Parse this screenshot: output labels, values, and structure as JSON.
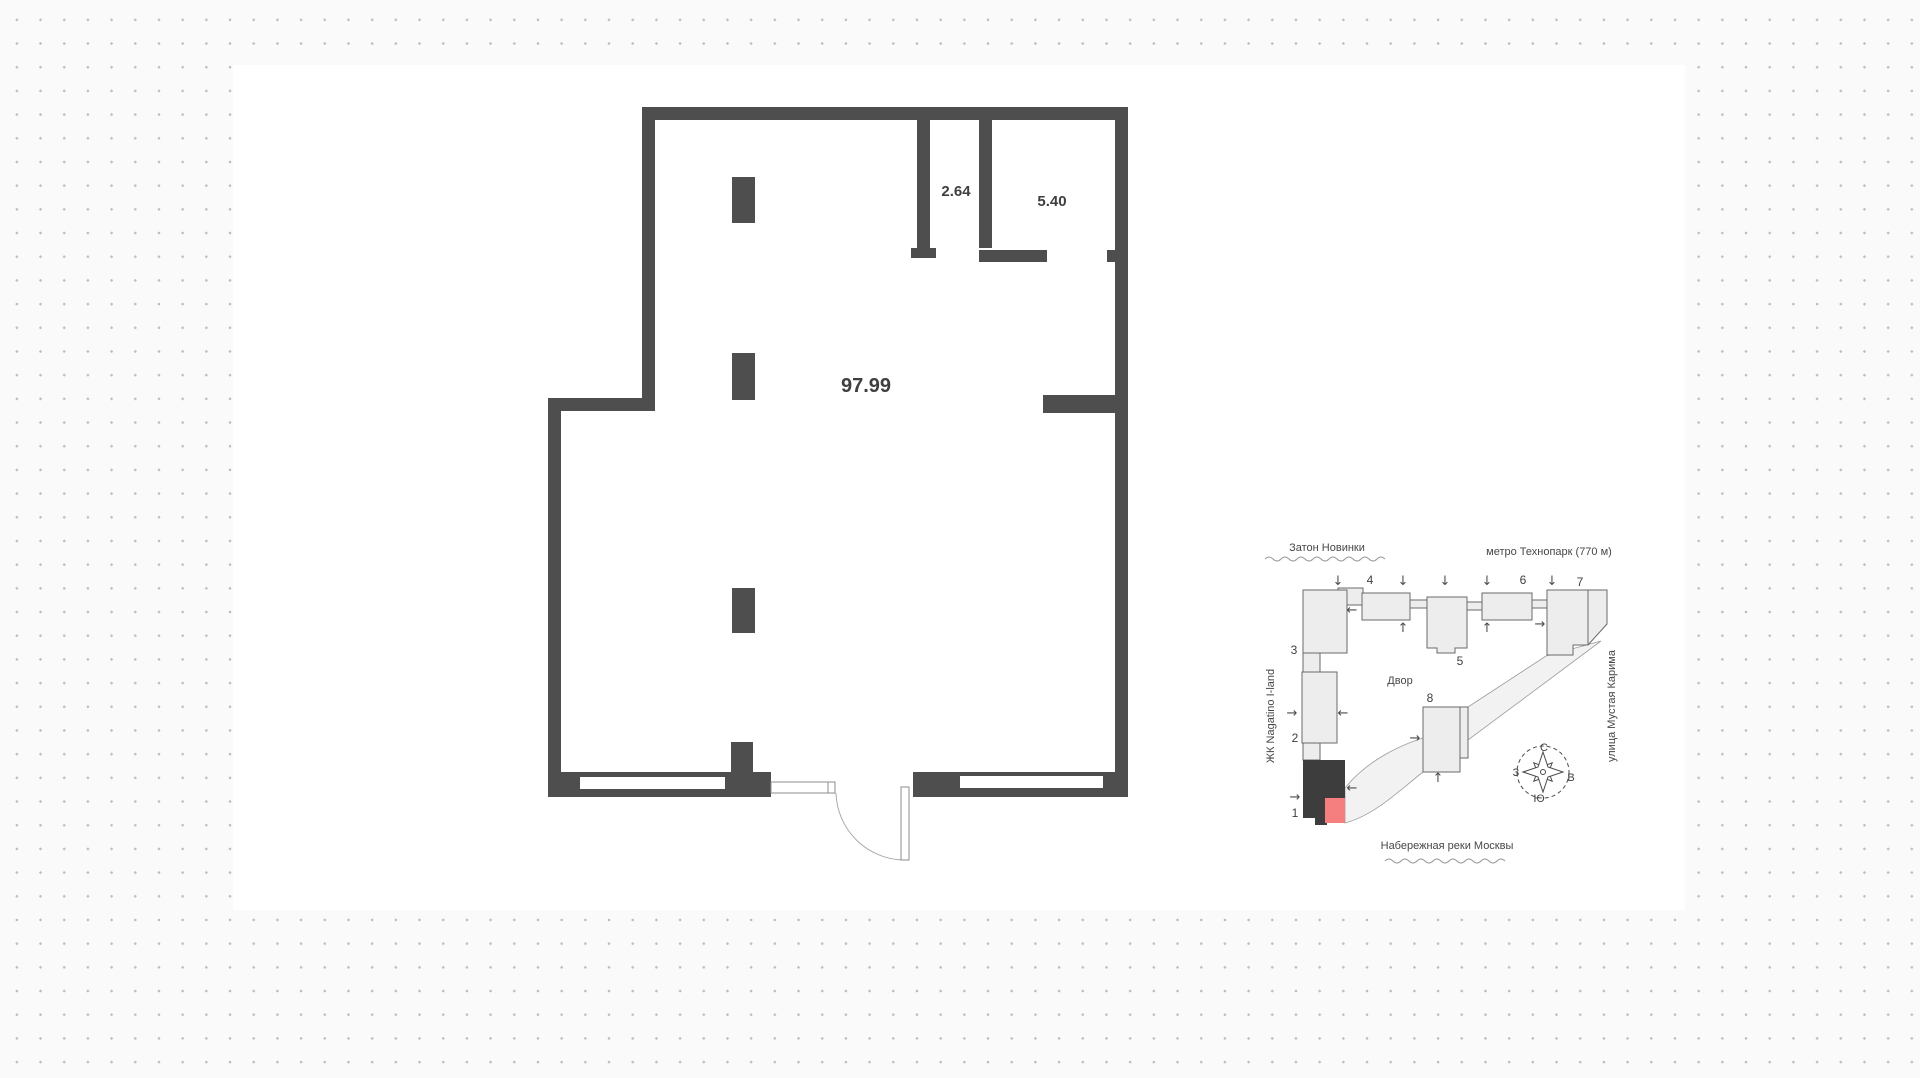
{
  "floor_plan": {
    "total_area": "97.99",
    "room_area_1": "2.64",
    "room_area_2": "5.40"
  },
  "site_plan": {
    "labels": {
      "district_top": "Затон Новинки",
      "metro": "метро Технопарк (770 м)",
      "complex": "ЖК Nagatino I-land",
      "street_right": "улица Мустая Карима",
      "embankment": "Набережная реки Москвы",
      "courtyard": "Двор"
    },
    "building_numbers": [
      "1",
      "2",
      "3",
      "4",
      "5",
      "6",
      "7",
      "8"
    ],
    "compass": {
      "north": "С",
      "south": "Ю",
      "east": "В",
      "west": "З"
    },
    "arrow_glyphs": {
      "up": "↑",
      "down": "↓",
      "left": "←",
      "right": "→"
    },
    "colors": {
      "wall": "#4e4e4e",
      "building_fill": "#ededed",
      "building_dark": "#3d3d3d",
      "highlight_unit": "#f57f7f"
    }
  }
}
